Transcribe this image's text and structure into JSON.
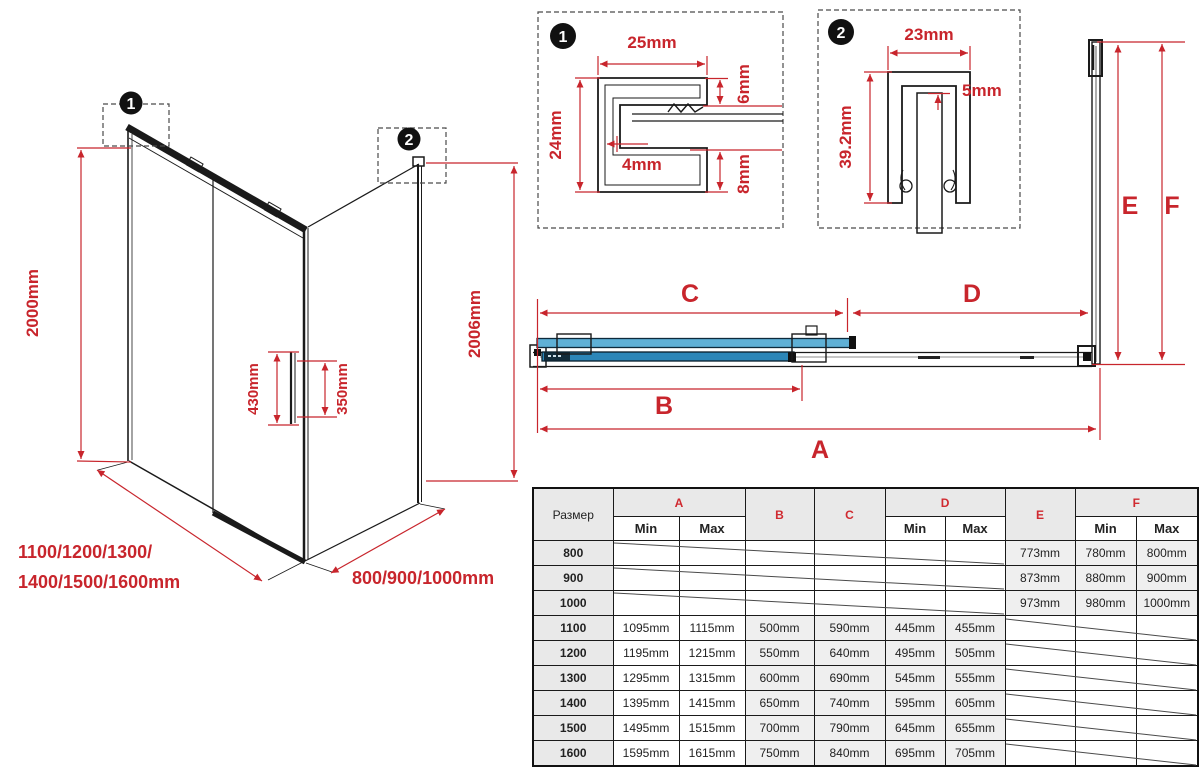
{
  "colors": {
    "dimension_red": "#c8252c",
    "drawing_black": "#1a1a1a",
    "glass_blue_fixed": "#5fb0d6",
    "glass_blue_door": "#2c86b8",
    "table_header_gray": "#e9e9e9",
    "table_cell_gray": "#efefef"
  },
  "markers": {
    "detail1": "1",
    "detail2": "2"
  },
  "iso": {
    "height": "2000mm",
    "side_height": "2006mm",
    "handle_length": "430mm",
    "handle_holes": "350mm",
    "widths_line1": "1100/1200/1300/",
    "widths_line2": "1400/1500/1600mm",
    "depths": "800/900/1000mm"
  },
  "detail1": {
    "width": "25mm",
    "height": "24mm",
    "wall": "4mm",
    "top_flange": "6mm",
    "bottom_flange": "8mm"
  },
  "detail2": {
    "width": "23mm",
    "gap": "5mm",
    "height": "39.2mm"
  },
  "plan": {
    "dim_a": "A",
    "dim_b": "B",
    "dim_c": "C",
    "dim_d": "D",
    "dim_e": "E",
    "dim_f": "F"
  },
  "table": {
    "size_label": "Размер",
    "min": "Min",
    "max": "Max",
    "cols": {
      "a": "A",
      "b": "B",
      "c": "C",
      "d": "D",
      "e": "E",
      "f": "F"
    },
    "rows": [
      {
        "size": "800",
        "e": "773mm",
        "f_min": "780mm",
        "f_max": "800mm"
      },
      {
        "size": "900",
        "e": "873mm",
        "f_min": "880mm",
        "f_max": "900mm"
      },
      {
        "size": "1000",
        "e": "973mm",
        "f_min": "980mm",
        "f_max": "1000mm"
      },
      {
        "size": "1100",
        "a_min": "1095mm",
        "a_max": "1115mm",
        "b": "500mm",
        "c": "590mm",
        "d_min": "445mm",
        "d_max": "455mm"
      },
      {
        "size": "1200",
        "a_min": "1195mm",
        "a_max": "1215mm",
        "b": "550mm",
        "c": "640mm",
        "d_min": "495mm",
        "d_max": "505mm"
      },
      {
        "size": "1300",
        "a_min": "1295mm",
        "a_max": "1315mm",
        "b": "600mm",
        "c": "690mm",
        "d_min": "545mm",
        "d_max": "555mm"
      },
      {
        "size": "1400",
        "a_min": "1395mm",
        "a_max": "1415mm",
        "b": "650mm",
        "c": "740mm",
        "d_min": "595mm",
        "d_max": "605mm"
      },
      {
        "size": "1500",
        "a_min": "1495mm",
        "a_max": "1515mm",
        "b": "700mm",
        "c": "790mm",
        "d_min": "645mm",
        "d_max": "655mm"
      },
      {
        "size": "1600",
        "a_min": "1595mm",
        "a_max": "1615mm",
        "b": "750mm",
        "c": "840mm",
        "d_min": "695mm",
        "d_max": "705mm"
      }
    ]
  }
}
